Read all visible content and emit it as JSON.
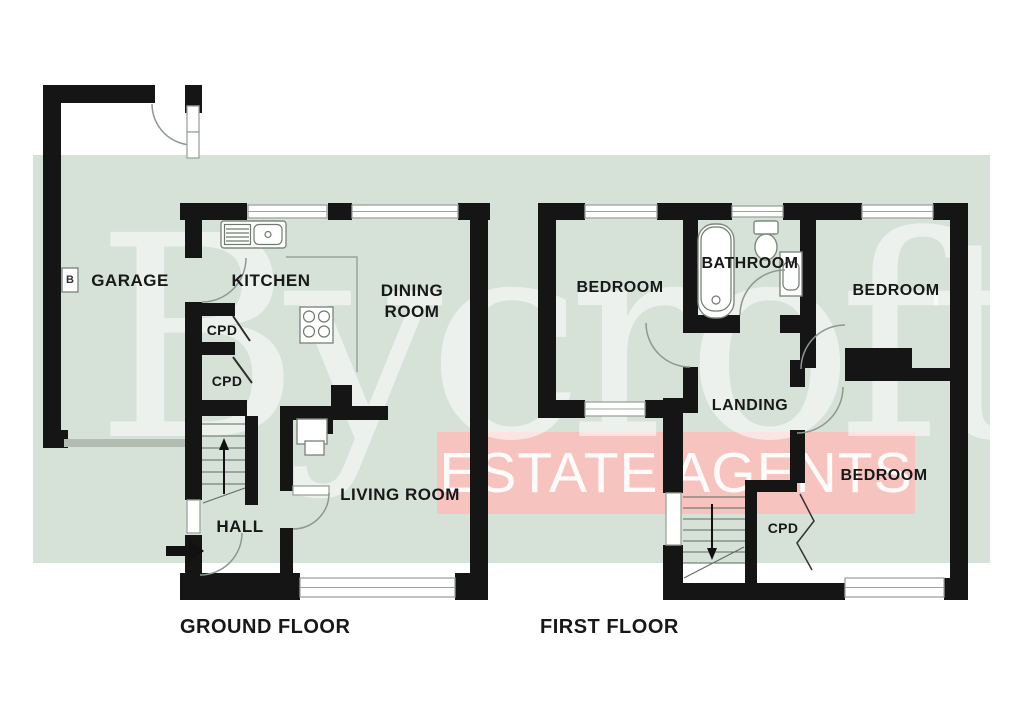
{
  "watermark": {
    "brand": "Bycroft",
    "banner": "ESTATE AGENTS"
  },
  "colors": {
    "background": "#ffffff",
    "plan_green": "#d6e1d7",
    "banner_pink": "#f6c3bf",
    "wall": "#151515",
    "label_ink": "#181818"
  },
  "floors": [
    {
      "name": "GROUND FLOOR",
      "rooms": [
        "GARAGE",
        "KITCHEN",
        "DINING ROOM",
        "CPD",
        "CPD",
        "HALL",
        "LIVING ROOM"
      ]
    },
    {
      "name": "FIRST FLOOR",
      "rooms": [
        "BEDROOM",
        "BATHROOM",
        "BEDROOM",
        "LANDING",
        "BEDROOM",
        "CPD"
      ]
    }
  ],
  "labels": {
    "garage": "GARAGE",
    "boiler": "B",
    "kitchen": "KITCHEN",
    "dining_room": "DINING ROOM",
    "cpd1": "CPD",
    "cpd2": "CPD",
    "hall": "HALL",
    "living_room": "LIVING ROOM",
    "ground_floor": "GROUND FLOOR",
    "bedroom1": "BEDROOM",
    "bathroom": "BATHROOM",
    "bedroom2": "BEDROOM",
    "landing": "LANDING",
    "bedroom3": "BEDROOM",
    "cpd3": "CPD",
    "first_floor": "FIRST FLOOR"
  }
}
